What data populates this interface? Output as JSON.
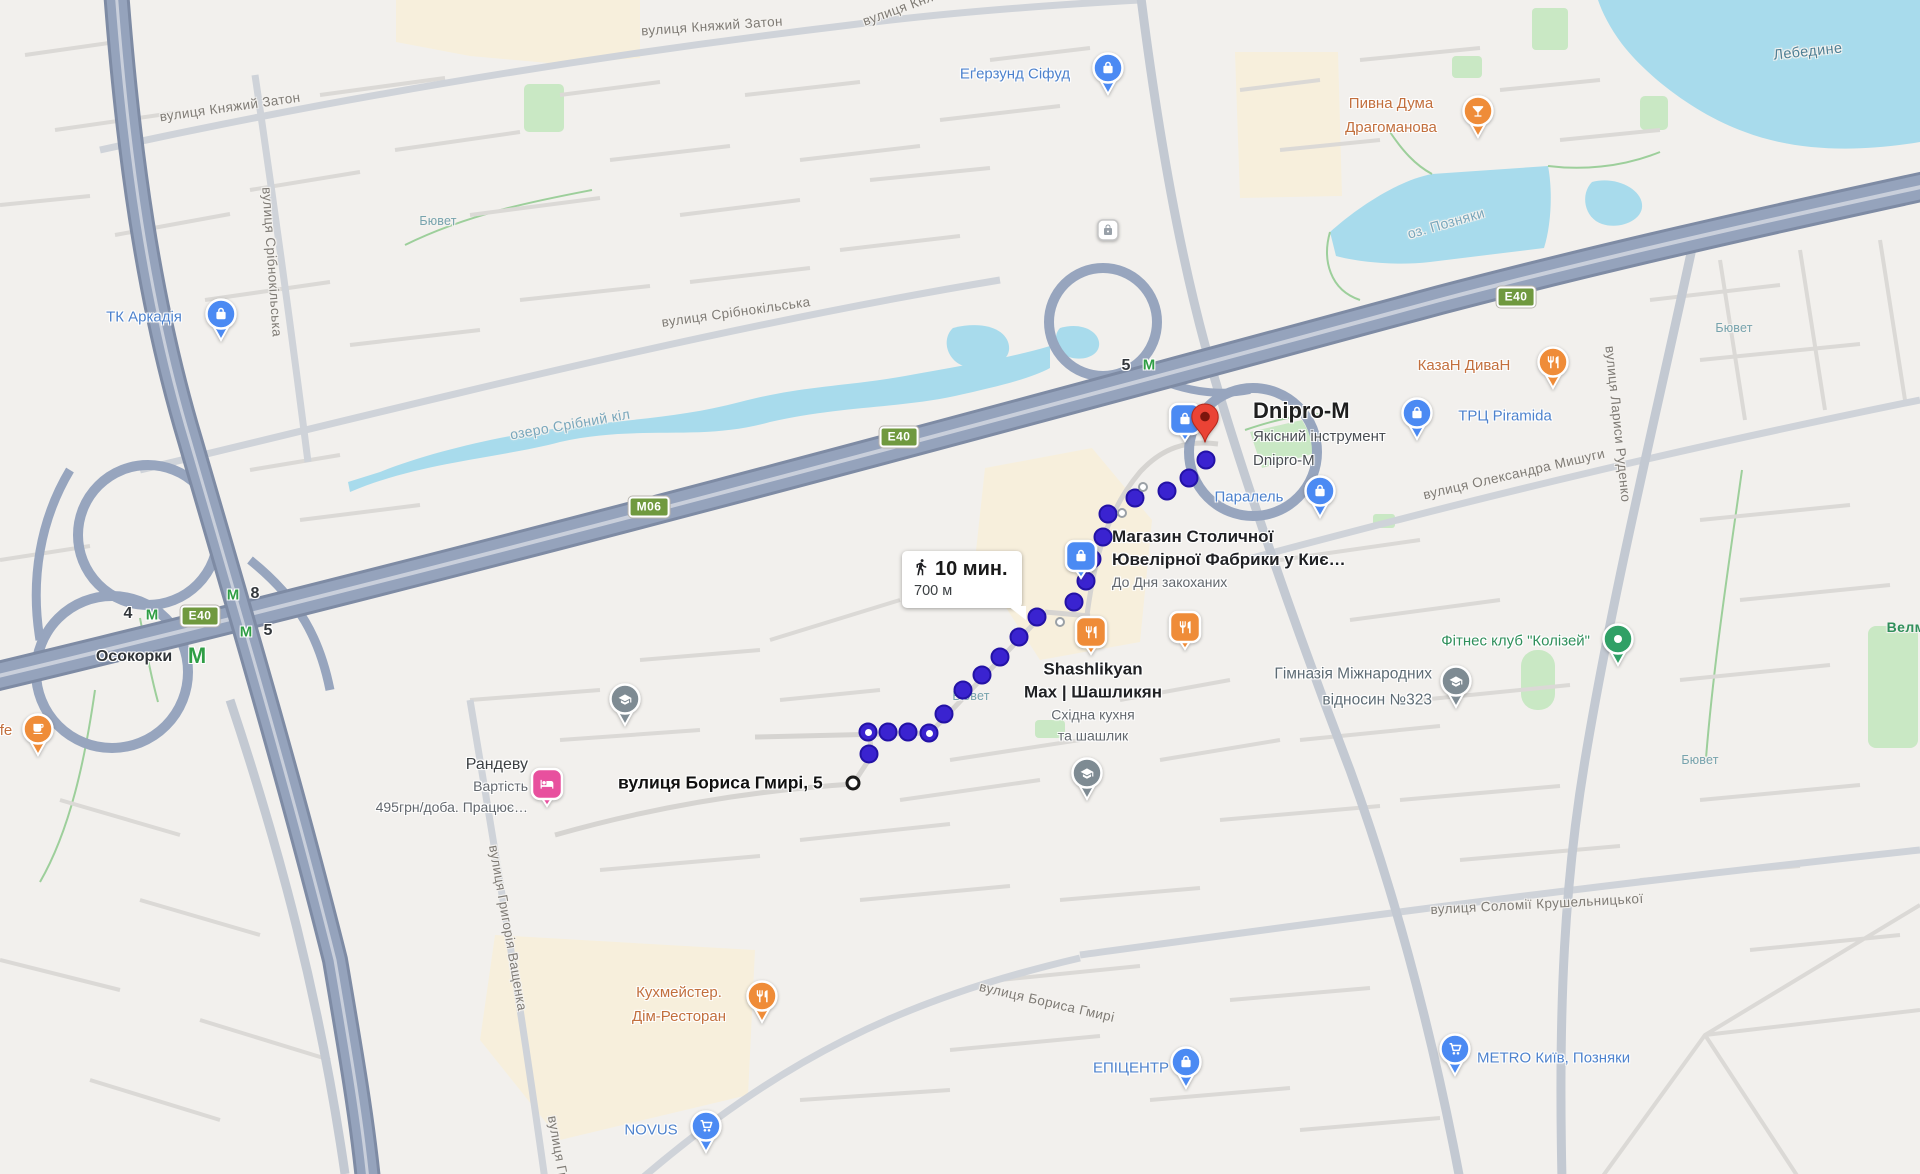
{
  "colors": {
    "bg": "#f2f0ed",
    "water": "#a8dbec",
    "park": "#c9e8c4",
    "landuse": "#f7efdc",
    "freeway": "#95a3bc",
    "freeway_casing": "#7e8ba4",
    "road_major": "#c3c9d2",
    "road_minor": "#dbd9d6",
    "route_dot": "#3a23d0",
    "pin_red": "#ea4335",
    "pin_blue": "#4b8af3",
    "pin_orange": "#ef8c38",
    "pin_pink": "#e8509e",
    "pin_gray": "#7e8b93",
    "pin_green": "#30a066",
    "metro_green": "#2f9e45"
  },
  "tooltip": {
    "mode_icon": "walking-icon",
    "duration": "10 мин.",
    "distance": "700 м"
  },
  "destination": {
    "title": "Dnipro-M",
    "line1": "Якісний інструмент",
    "line2": "Dnipro-M"
  },
  "start": {
    "label": "вулиця Бориса Гмирі, 5"
  },
  "route": {
    "dots": [
      [
        869,
        754
      ],
      [
        868,
        732,
        1
      ],
      [
        888,
        732
      ],
      [
        908,
        732
      ],
      [
        929,
        733,
        1
      ],
      [
        944,
        714
      ],
      [
        963,
        690
      ],
      [
        982,
        675
      ],
      [
        1000,
        657
      ],
      [
        1019,
        637
      ],
      [
        1037,
        617
      ],
      [
        1074,
        602
      ],
      [
        1086,
        581
      ],
      [
        1092,
        559
      ],
      [
        1103,
        537
      ],
      [
        1108,
        514
      ],
      [
        1135,
        498
      ],
      [
        1167,
        491
      ],
      [
        1189,
        478
      ],
      [
        1206,
        460
      ]
    ],
    "via_dots": [
      [
        1060,
        622
      ],
      [
        1122,
        513
      ],
      [
        1143,
        487
      ]
    ],
    "start_ring": [
      853,
      783
    ],
    "destination_pin": [
      1205,
      443
    ]
  },
  "shields": [
    {
      "t": "E40",
      "x": 200,
      "y": 616
    },
    {
      "t": "M06",
      "x": 649,
      "y": 507
    },
    {
      "t": "E40",
      "x": 899,
      "y": 437
    },
    {
      "t": "E40",
      "x": 1516,
      "y": 297
    }
  ],
  "metro": [
    {
      "t": "4",
      "cls": "mnum",
      "x": 128,
      "y": 614
    },
    {
      "t": "М",
      "cls": "mM",
      "x": 152,
      "y": 615
    },
    {
      "t": "М",
      "cls": "mM",
      "x": 233,
      "y": 595
    },
    {
      "t": "8",
      "cls": "mnum",
      "x": 255,
      "y": 594
    },
    {
      "t": "М",
      "cls": "mM",
      "x": 246,
      "y": 632
    },
    {
      "t": "5",
      "cls": "mnum",
      "x": 268,
      "y": 631
    },
    {
      "t": "Осокорки",
      "cls": "mname",
      "x": 134,
      "y": 657
    },
    {
      "t": "М",
      "cls": "mM big",
      "x": 197,
      "y": 656
    },
    {
      "t": "5",
      "cls": "mnum",
      "x": 1126,
      "y": 366
    },
    {
      "t": "М",
      "cls": "mM",
      "x": 1149,
      "y": 365
    }
  ],
  "map_labels": [
    {
      "t": "вулиця Княжий Затон",
      "x": 230,
      "y": 107,
      "r": -8,
      "cls": "street"
    },
    {
      "t": "вулиця Княжий Затон",
      "x": 712,
      "y": 26,
      "r": -4,
      "cls": "street"
    },
    {
      "t": "вулиця Кня",
      "x": 898,
      "y": 9,
      "r": -20,
      "cls": "street"
    },
    {
      "t": "вулиця Срібнокільська",
      "x": 272,
      "y": 262,
      "r": 86,
      "cls": "street"
    },
    {
      "t": "вулиця Срібнокільська",
      "x": 736,
      "y": 312,
      "r": -8,
      "cls": "street"
    },
    {
      "t": "вулиця Лариси Руденко",
      "x": 1618,
      "y": 424,
      "r": 84,
      "cls": "street"
    },
    {
      "t": "вулиця Олександра Мишуги",
      "x": 1514,
      "y": 474,
      "r": -13,
      "cls": "street"
    },
    {
      "t": "вулиця Соломії Крушельницької",
      "x": 1537,
      "y": 904,
      "r": -3,
      "cls": "street"
    },
    {
      "t": "вулиця Бориса Гмирі",
      "x": 1047,
      "y": 1002,
      "r": 13,
      "cls": "street"
    },
    {
      "t": "вулиця Григорія Ващенка",
      "x": 508,
      "y": 928,
      "r": 80,
      "cls": "street"
    },
    {
      "t": "вулиця Гр",
      "x": 558,
      "y": 1148,
      "r": 80,
      "cls": "street"
    },
    {
      "t": "озеро Срібний кіл",
      "x": 570,
      "y": 424,
      "r": -10,
      "cls": "water"
    },
    {
      "t": "оз. Позняки",
      "x": 1446,
      "y": 223,
      "r": -16,
      "cls": "water"
    },
    {
      "t": "Лебедине",
      "x": 1808,
      "y": 52,
      "r": -6,
      "cls": "lakedark"
    },
    {
      "t": "Бювет",
      "x": 438,
      "y": 221,
      "r": 0,
      "cls": "buvet"
    },
    {
      "t": "Бювет",
      "x": 971,
      "y": 696,
      "r": 0,
      "cls": "buvet"
    },
    {
      "t": "Бювет",
      "x": 1700,
      "y": 760,
      "r": 0,
      "cls": "buvet"
    },
    {
      "t": "Бювет",
      "x": 1734,
      "y": 328,
      "r": 0,
      "cls": "buvet"
    },
    {
      "t": "Велма",
      "x": 1910,
      "y": 627,
      "r": 0,
      "cls": "green"
    }
  ],
  "pois": [
    {
      "name": "cafe-partial",
      "icon": "coffee",
      "shape": "pin",
      "color": "pin_orange",
      "x": 38,
      "y": 729,
      "label": {
        "x": 6,
        "y": 731,
        "align": "center",
        "lines": [
          {
            "t": "fe",
            "cls": "t-orange"
          }
        ]
      }
    },
    {
      "name": "tk-arkadia",
      "icon": "bag",
      "shape": "pin",
      "color": "pin_blue",
      "x": 221,
      "y": 314,
      "label": {
        "x": 144,
        "y": 317,
        "align": "center",
        "lines": [
          {
            "t": "ТК Аркадія",
            "cls": "t-blue"
          }
        ]
      }
    },
    {
      "name": "egersund-sifud",
      "icon": "bag",
      "shape": "pin",
      "color": "pin_blue",
      "x": 1108,
      "y": 68,
      "label": {
        "x": 1015,
        "y": 74,
        "align": "center",
        "lines": [
          {
            "t": "Еґерзунд Сіфуд",
            "cls": "t-blue"
          }
        ]
      }
    },
    {
      "name": "pyvna-duma",
      "icon": "cocktail",
      "shape": "pin",
      "color": "pin_orange",
      "x": 1478,
      "y": 111,
      "label": {
        "x": 1391,
        "y": 116,
        "align": "center",
        "lines": [
          {
            "t": "Пивна Дума",
            "cls": "t-orange"
          },
          {
            "t": "Драгоманова",
            "cls": "t-orange"
          }
        ]
      }
    },
    {
      "name": "kazan-dyvan",
      "icon": "fork",
      "shape": "pin",
      "color": "pin_orange",
      "x": 1553,
      "y": 362,
      "label": {
        "x": 1464,
        "y": 366,
        "align": "center",
        "lines": [
          {
            "t": "КазаН ДиваН",
            "cls": "t-orange"
          }
        ]
      }
    },
    {
      "name": "trc-piramida",
      "icon": "bag",
      "shape": "pin",
      "color": "pin_blue",
      "x": 1417,
      "y": 413,
      "label": {
        "x": 1505,
        "y": 416,
        "align": "center",
        "lines": [
          {
            "t": "ТРЦ Piramida",
            "cls": "t-blue"
          }
        ]
      }
    },
    {
      "name": "paralel",
      "icon": "bag",
      "shape": "pin",
      "color": "pin_blue",
      "x": 1320,
      "y": 491,
      "label": {
        "x": 1249,
        "y": 497,
        "align": "center",
        "lines": [
          {
            "t": "Паралель",
            "cls": "t-blue"
          }
        ]
      }
    },
    {
      "name": "dnipro-m-store",
      "icon": "bag",
      "shape": "badge",
      "color": "pin_blue",
      "x": 1185,
      "y": 419,
      "label": null
    },
    {
      "name": "mahazyn-stolychnoi",
      "icon": "bag",
      "shape": "badge",
      "color": "pin_blue",
      "x": 1081,
      "y": 556,
      "label": {
        "x": 1112,
        "y": 559,
        "align": "left",
        "lines": [
          {
            "t": "Магазин Столичної",
            "cls": "t-dark"
          },
          {
            "t": "Ювелірної Фабрики у Киє…",
            "cls": "t-dark"
          },
          {
            "t": "До Дня закоханих",
            "cls": "t-sub"
          }
        ]
      }
    },
    {
      "name": "shashlikyan-max",
      "icon": "fork",
      "shape": "badge",
      "color": "pin_orange",
      "x": 1091,
      "y": 632,
      "label": {
        "x": 1093,
        "y": 702,
        "align": "center",
        "lines": [
          {
            "t": "Shashlikyan",
            "cls": "t-dark"
          },
          {
            "t": "Max | Шашликян",
            "cls": "t-dark"
          },
          {
            "t": "Східна кухня",
            "cls": "t-sub"
          },
          {
            "t": "та шашлик",
            "cls": "t-sub"
          }
        ]
      }
    },
    {
      "name": "restaurant-2",
      "icon": "fork",
      "shape": "badge",
      "color": "pin_orange",
      "x": 1185,
      "y": 627,
      "label": null
    },
    {
      "name": "himnaziya-323",
      "icon": "grad",
      "shape": "pin",
      "color": "pin_gray",
      "x": 1456,
      "y": 681,
      "label": {
        "x": 1432,
        "y": 687,
        "align": "right",
        "lines": [
          {
            "t": "Гімназія Міжнародних",
            "cls": "t-gray"
          },
          {
            "t": "відносин №323",
            "cls": "t-gray"
          }
        ]
      }
    },
    {
      "name": "fitnes-kolizey",
      "icon": "dot",
      "shape": "pin",
      "color": "pin_green",
      "x": 1618,
      "y": 639,
      "label": {
        "x": 1590,
        "y": 641,
        "align": "right",
        "lines": [
          {
            "t": "Фітнес клуб \"Колізей\"",
            "cls": "t-green"
          }
        ]
      }
    },
    {
      "name": "randevu-hotel",
      "icon": "bed",
      "shape": "badge",
      "color": "pin_pink",
      "x": 547,
      "y": 784,
      "label": {
        "x": 528,
        "y": 786,
        "align": "right",
        "lines": [
          {
            "t": "Рандеву",
            "cls": "t-plain"
          },
          {
            "t": "Вартість",
            "cls": "t-sub"
          },
          {
            "t": "495грн/доба. Працює…",
            "cls": "t-sub"
          }
        ]
      }
    },
    {
      "name": "kuhmeister",
      "icon": "fork",
      "shape": "pin",
      "color": "pin_orange",
      "x": 762,
      "y": 996,
      "label": {
        "x": 679,
        "y": 1005,
        "align": "center",
        "lines": [
          {
            "t": "Кухмейстер.",
            "cls": "t-orange"
          },
          {
            "t": "Дім-Ресторан",
            "cls": "t-orange"
          }
        ]
      }
    },
    {
      "name": "novus",
      "icon": "cart",
      "shape": "pin",
      "color": "pin_blue",
      "x": 706,
      "y": 1126,
      "label": {
        "x": 651,
        "y": 1130,
        "align": "center",
        "lines": [
          {
            "t": "NOVUS",
            "cls": "t-blue"
          }
        ]
      }
    },
    {
      "name": "epicentr",
      "icon": "bag",
      "shape": "pin",
      "color": "pin_blue",
      "x": 1186,
      "y": 1062,
      "label": {
        "x": 1131,
        "y": 1068,
        "align": "center",
        "lines": [
          {
            "t": "ЕПІЦЕНТР",
            "cls": "t-blue"
          }
        ]
      }
    },
    {
      "name": "metro-kyiv-pozniaky",
      "icon": "cart",
      "shape": "pin",
      "color": "pin_blue",
      "x": 1455,
      "y": 1049,
      "label": {
        "x": 1477,
        "y": 1058,
        "align": "left",
        "lines": [
          {
            "t": "METRO Київ, Позняки",
            "cls": "t-blue"
          }
        ]
      }
    },
    {
      "name": "school-1",
      "icon": "grad",
      "shape": "pin",
      "color": "pin_gray",
      "x": 625,
      "y": 699,
      "label": null
    },
    {
      "name": "school-2",
      "icon": "grad",
      "shape": "pin",
      "color": "pin_gray",
      "x": 1087,
      "y": 773,
      "label": null
    },
    {
      "name": "security-gate",
      "icon": "lock",
      "shape": "badge-mini",
      "color": "pin_gray",
      "x": 1108,
      "y": 230,
      "label": null
    }
  ]
}
